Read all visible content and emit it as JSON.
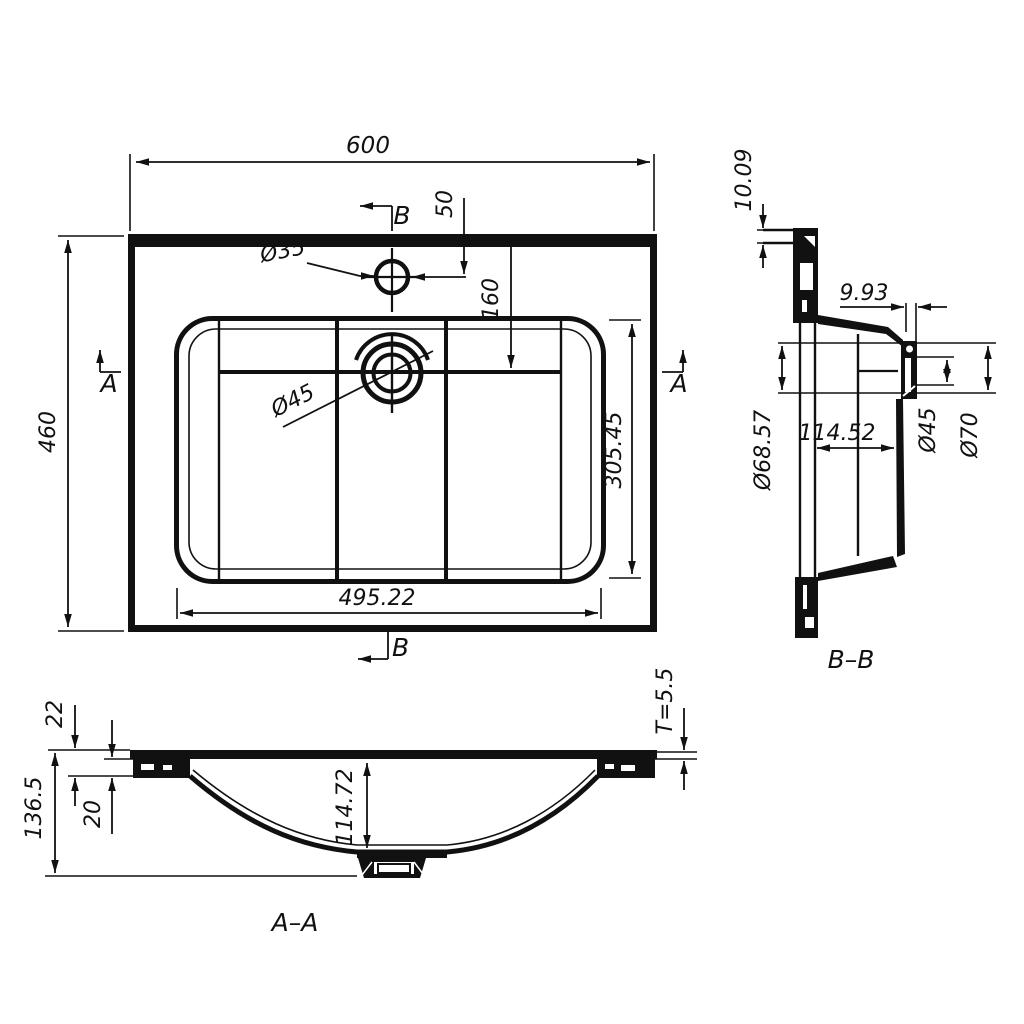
{
  "drawing": {
    "plan": {
      "overall_width": "600",
      "overall_depth": "460",
      "faucet_hole_dia": "Ø35",
      "faucet_hole_offset": "50",
      "drain_offset": "160",
      "bowl_depth": "305.45",
      "bowl_width": "495.22",
      "section_b": "B",
      "section_a": "A"
    },
    "section_bb": {
      "label": "B–B",
      "rear_edge_thickness": "10.09",
      "front_wall_thickness": "9.93",
      "drain_seat_dia": "Ø68.57",
      "bowl_depth_at_drain": "114.52",
      "drain_hole_dia": "Ø45",
      "drain_flange_dia": "Ø70"
    },
    "section_aa": {
      "label": "A–A",
      "rim_height_outer": "22",
      "rim_height_inner": "20",
      "overall_height": "136.5",
      "bowl_inner_depth": "114.72",
      "top_plate_thickness": "T=5.5"
    }
  }
}
